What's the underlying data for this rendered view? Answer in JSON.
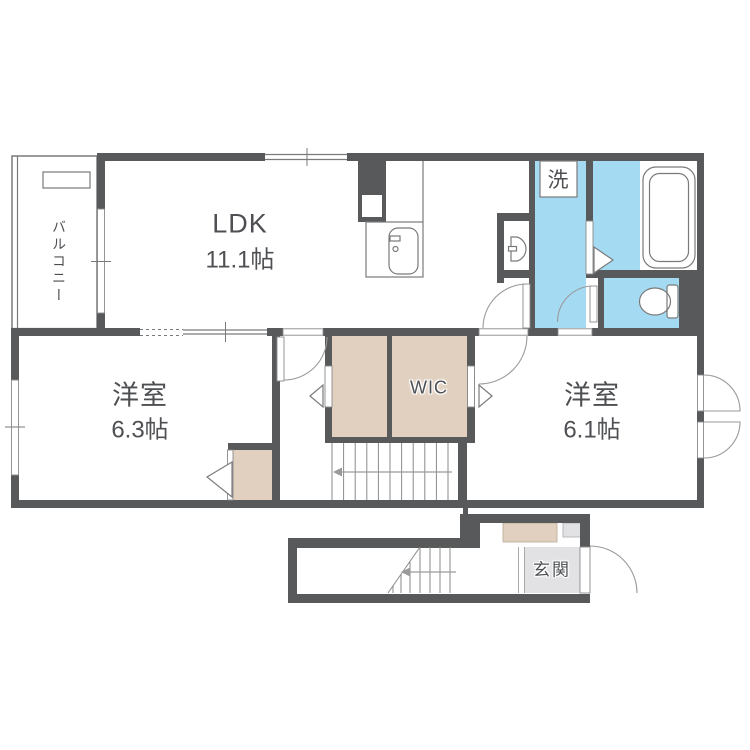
{
  "floorplan": {
    "title": "2F apartment floor plan",
    "rooms": {
      "ldk": {
        "name": "LDK",
        "size": "11.1帖"
      },
      "bedroom_west": {
        "name": "洋室",
        "size": "6.3帖"
      },
      "bedroom_east": {
        "name": "洋室",
        "size": "6.1帖"
      },
      "wic": {
        "label": "WIC"
      },
      "laundry": {
        "label": "洗"
      },
      "balcony": {
        "label": "バルコニー"
      },
      "entrance": {
        "label": "玄関"
      }
    },
    "colors": {
      "wall": "#58595b",
      "water_blue": "#a5daf3",
      "closet_beige": "#e1d0bf",
      "entrance_gray": "#e2e2e4",
      "text": "#4d4f52"
    }
  }
}
